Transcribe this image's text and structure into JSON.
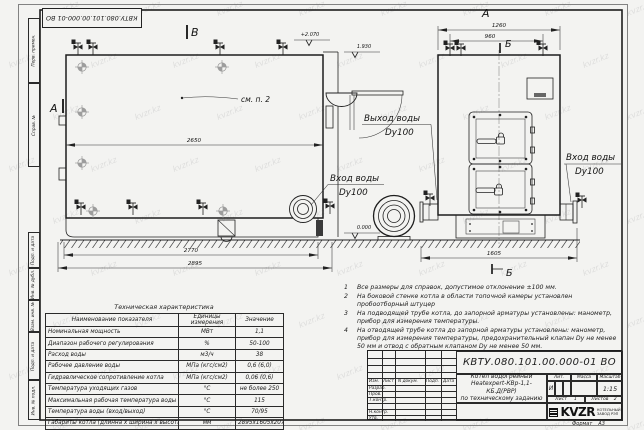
{
  "watermark": {
    "text": "kvzr.kz"
  },
  "frame": {
    "stamp_code": "КВТУ.080.101.00.000-01 ВО",
    "side_labels_top": [
      "Перв. примен.",
      "Справ. №"
    ],
    "side_labels_bottom": [
      "Подп. и дата",
      "Инв. № дубл.",
      "Взам. инв. №",
      "Подп. и дата",
      "Инв. № подл."
    ],
    "format_label": "Формат",
    "format_value": "А3"
  },
  "drawing": {
    "section_labels": {
      "v": "В",
      "a_side": "А",
      "a_front": "А",
      "b_top": "Б",
      "b_bottom": "Б"
    },
    "see_note": "см. п. 2",
    "elevations": {
      "top": "+2.070",
      "mid": "1.930",
      "zero": "0.000"
    },
    "dims": {
      "d2650": "2650",
      "d2770": "2770",
      "d2895": "2895",
      "d1260": "1260",
      "d960": "960",
      "d1605": "1605"
    },
    "labels": {
      "outlet_line1": "Выход воды",
      "outlet_line2": "Dy100",
      "inlet_side_line1": "Вход воды",
      "inlet_side_line2": "Dy100",
      "inlet_front_line1": "Вход воды",
      "inlet_front_line2": "Dy100"
    }
  },
  "notes": {
    "items": [
      {
        "num": "1",
        "text": "Все размеры для справок, допустимое отклонение ±100 мм."
      },
      {
        "num": "2",
        "text": "На боковой стенке котла в области топочной камеры установлен пробоотборный штуцер"
      },
      {
        "num": "3",
        "text": "На подводящей трубе котла, до запорной арматуры установлены: манометр, прибор для измерения температуры."
      },
      {
        "num": "4",
        "text": "На отводящей трубе котла до запорной арматуры установлены: манометр, прибор для измерения температуры, предохранительный клапан Dу не менее 50 мм и отвод с обратным клапаном Dу не менее 50 мм."
      }
    ]
  },
  "spec_table": {
    "title": "Техническая характеристика",
    "headers": [
      "Наименование показателя",
      "Единицы измерения",
      "Значение"
    ],
    "rows": [
      [
        "Номинальная мощность",
        "МВт",
        "1,1"
      ],
      [
        "Диапазон рабочего регулирования",
        "%",
        "50-100"
      ],
      [
        "Расход воды",
        "м3/ч",
        "38"
      ],
      [
        "Рабочее давление воды",
        "МПа (кгс/см2)",
        "0,6 (6,0)"
      ],
      [
        "Гидравлическое сопротивление котла",
        "МПа (кгс/см2)",
        "0,06 (0,6)"
      ],
      [
        "Температура уходящих газов",
        "°С",
        "не более 250"
      ],
      [
        "Максимальная рабочая температура воды",
        "°С",
        "115"
      ],
      [
        "Температура воды (вход/выход)",
        "°С",
        "70/95"
      ],
      [
        "Габариты котла (длинна х ширина х высота)",
        "мм",
        "2895х1605х2070"
      ]
    ]
  },
  "title_block": {
    "doc_number": "КВТУ.080.101.00.000-01 ВО",
    "product_line1": "Котел водогрейный",
    "product_line2": "Heatexpert-КВр-1,1-КБ.Д(РВР)",
    "product_line3": "по техническому заданию",
    "columns": [
      "Изм.",
      "Лист",
      "N докум.",
      "Подп.",
      "Дата"
    ],
    "signature_rows": [
      "Разраб.",
      "Пров.",
      "Т.контр.",
      "Н.контр.",
      "Утв."
    ],
    "lit_label": "Лит.",
    "lit_value": "И",
    "mass_label": "Масса",
    "scale_label": "Масштаб",
    "scale_value": "1:15",
    "sheet_label": "Лист",
    "sheet_value": "1",
    "sheets_label": "Листов",
    "sheets_value": "2",
    "logo": "KVZR",
    "company_line1": "КОТЕЛЬНЫЙ",
    "company_line2": "ЗАВОД РЭП"
  }
}
